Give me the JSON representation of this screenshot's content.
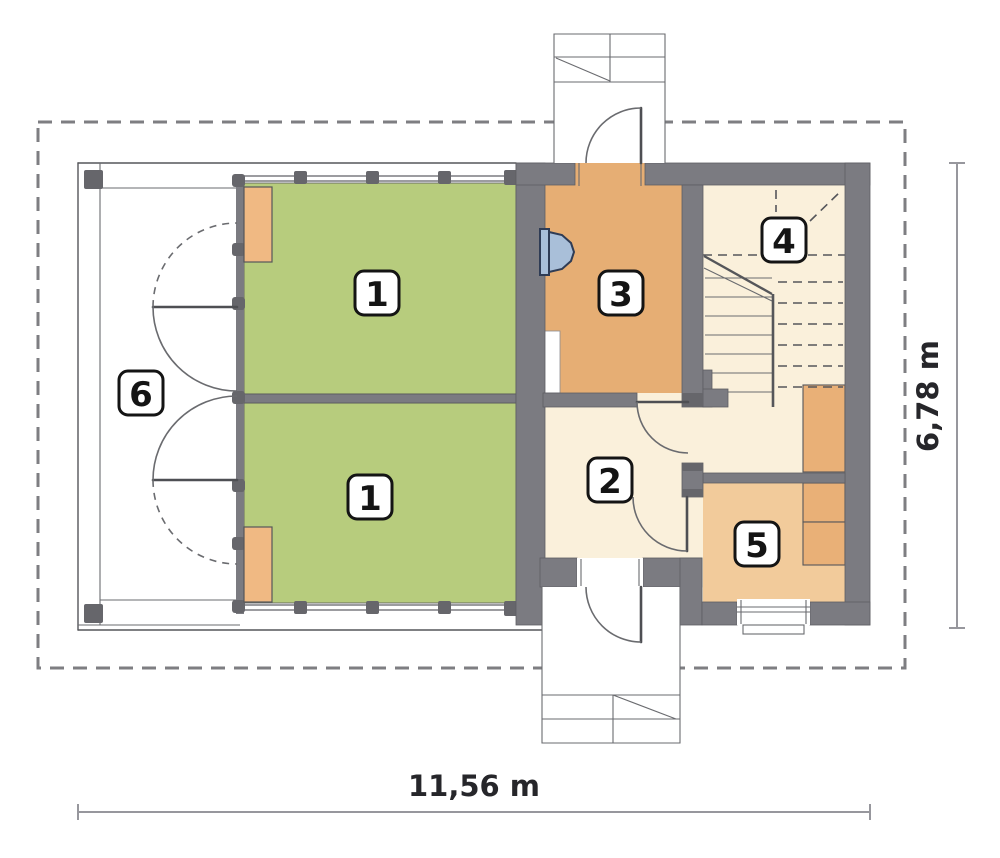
{
  "plan": {
    "rooms": [
      {
        "number": "1"
      },
      {
        "number": "1"
      },
      {
        "number": "2"
      },
      {
        "number": "3"
      },
      {
        "number": "4"
      },
      {
        "number": "5"
      },
      {
        "number": "6"
      }
    ],
    "dimensions": {
      "width": "11,56 m",
      "height": "6,78 m"
    },
    "colors": {
      "wall": "#7B7B81",
      "wall_dark": "#66666B",
      "green": "#B7CC7D",
      "orange": "#E6AE74",
      "tan": "#F2CB9B",
      "cream": "#FAF0DB",
      "furniture": "#E9B077",
      "panel": "#F0B983",
      "sink_fill": "#A9BFD9",
      "sink_stroke": "#2F3C55",
      "boundary_dash": "#7E7E82"
    }
  }
}
